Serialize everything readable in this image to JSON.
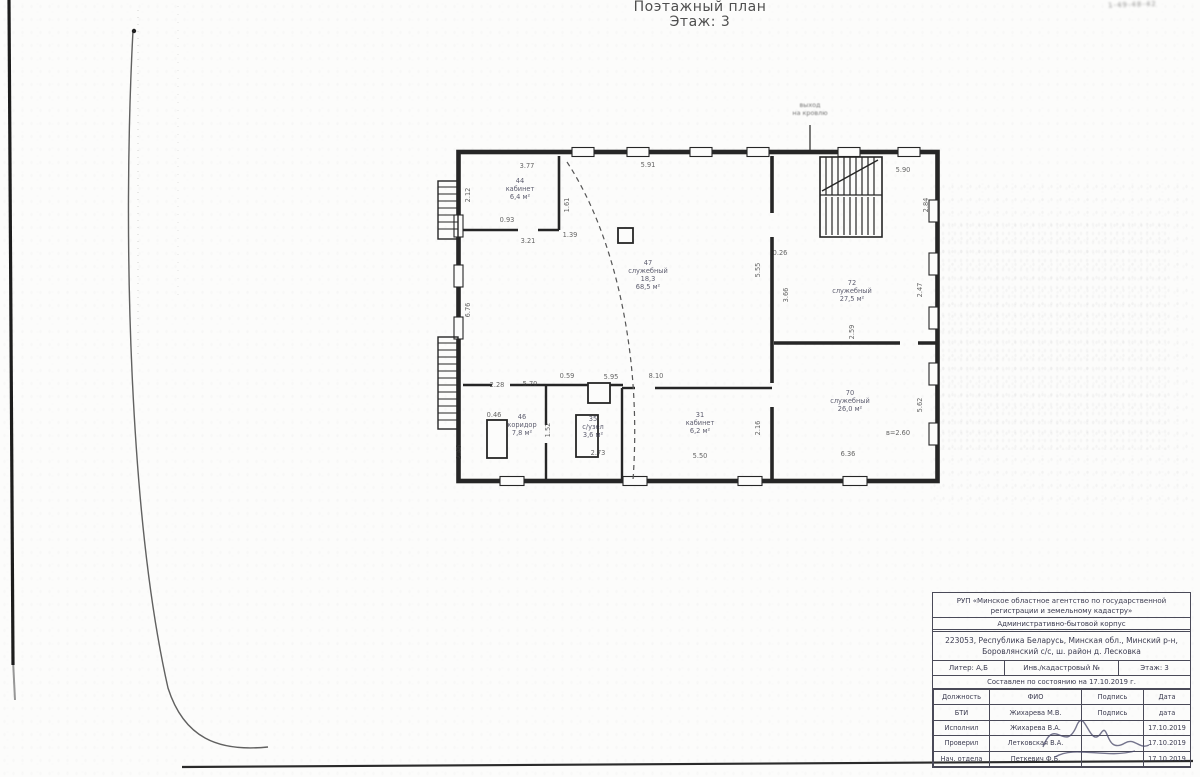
{
  "colors": {
    "ink": "#2b2b2b",
    "stamp_ink": "#3b3b50",
    "paper": "#fcfcfb"
  },
  "page": {
    "title_line1": "Поэтажный план",
    "title_line2": "Этаж: 3",
    "corner_note": "1-49-48-42"
  },
  "plan": {
    "entrance_note": {
      "x": 380,
      "y": 12,
      "lines": [
        "выход",
        "на кровлю"
      ]
    },
    "rooms": [
      {
        "x": 90,
        "y": 88,
        "lines": [
          "44",
          "кабинет",
          "6,4 м²"
        ]
      },
      {
        "x": 218,
        "y": 170,
        "lines": [
          "47",
          "служебный",
          "18,3",
          "68,5 м²"
        ]
      },
      {
        "x": 422,
        "y": 190,
        "lines": [
          "72",
          "служебный",
          "27,5 м²"
        ]
      },
      {
        "x": 420,
        "y": 300,
        "lines": [
          "70",
          "служебный",
          "26,0 м²"
        ]
      },
      {
        "x": 92,
        "y": 324,
        "lines": [
          "46",
          "коридор",
          "7,8 м²"
        ]
      },
      {
        "x": 163,
        "y": 326,
        "lines": [
          "35",
          "с/узел",
          "3,6 м²"
        ]
      },
      {
        "x": 270,
        "y": 322,
        "lines": [
          "31",
          "кабинет",
          "6,2 м²"
        ]
      }
    ],
    "dimensions": [
      {
        "t": "3.77",
        "x": 97,
        "y": 73
      },
      {
        "t": "5.91",
        "x": 218,
        "y": 72
      },
      {
        "t": "5.90",
        "x": 473,
        "y": 77
      },
      {
        "t": "1.61",
        "x": 139,
        "y": 110,
        "r": 1
      },
      {
        "t": "2.12",
        "x": 40,
        "y": 100,
        "r": 1
      },
      {
        "t": "2.84",
        "x": 498,
        "y": 110,
        "r": 1
      },
      {
        "t": "0.93",
        "x": 77,
        "y": 127
      },
      {
        "t": "3.21",
        "x": 98,
        "y": 148
      },
      {
        "t": "1.39",
        "x": 140,
        "y": 142
      },
      {
        "t": "0.26",
        "x": 350,
        "y": 160
      },
      {
        "t": "5.55",
        "x": 330,
        "y": 175,
        "r": 1
      },
      {
        "t": "3.66",
        "x": 358,
        "y": 200,
        "r": 1
      },
      {
        "t": "2.47",
        "x": 492,
        "y": 195,
        "r": 1
      },
      {
        "t": "6.76",
        "x": 40,
        "y": 215,
        "r": 1
      },
      {
        "t": "2.59",
        "x": 424,
        "y": 237,
        "r": 1
      },
      {
        "t": "0.46",
        "x": 64,
        "y": 322
      },
      {
        "t": "2.28",
        "x": 67,
        "y": 292
      },
      {
        "t": "5.70",
        "x": 100,
        "y": 291
      },
      {
        "t": "0.59",
        "x": 137,
        "y": 283
      },
      {
        "t": "5.95",
        "x": 181,
        "y": 284
      },
      {
        "t": "8.10",
        "x": 226,
        "y": 283
      },
      {
        "t": "1.52",
        "x": 120,
        "y": 335,
        "r": 1
      },
      {
        "t": "2.16",
        "x": 330,
        "y": 333,
        "r": 1
      },
      {
        "t": "5.62",
        "x": 492,
        "y": 310,
        "r": 1
      },
      {
        "t": "2.73",
        "x": 168,
        "y": 360
      },
      {
        "t": "5.50",
        "x": 270,
        "y": 363
      },
      {
        "t": "6.36",
        "x": 418,
        "y": 361
      },
      {
        "t": "2.46",
        "x": 31,
        "y": 357,
        "r": 1
      },
      {
        "t": "в=2.60",
        "x": 468,
        "y": 340
      }
    ]
  },
  "stamp": {
    "org_line1": "РУП «Минское областное агентство по государственной",
    "org_line2": "регистрации и земельному кадастру»",
    "org_line3": "Административно-бытовой корпус",
    "addr_line1": "223053, Республика Беларусь, Минская обл., Минский р-н,",
    "addr_line2": "Боровлянский с/с, ш. район д. Лесковка",
    "liter": "Литер: А,Б",
    "cad": "Инв./кадастровый №",
    "floor": "Этаж: 3",
    "date_line": "Составлен по состоянию на 17.10.2019 г.",
    "table": {
      "rows": [
        [
          "Должность",
          "ФИО",
          "Подпись",
          "Дата"
        ],
        [
          "БТИ",
          "Жихарева М.В.",
          "Подпись",
          "дата"
        ],
        [
          "Исполнил",
          "Жихарева В.А.",
          "",
          "17.10.2019"
        ],
        [
          "Проверил",
          "Летковская В.А.",
          "",
          "17.10.2019"
        ],
        [
          "Нач. отдела",
          "Петкевич Ф.Б.",
          "",
          "17.10.2019"
        ]
      ]
    }
  }
}
